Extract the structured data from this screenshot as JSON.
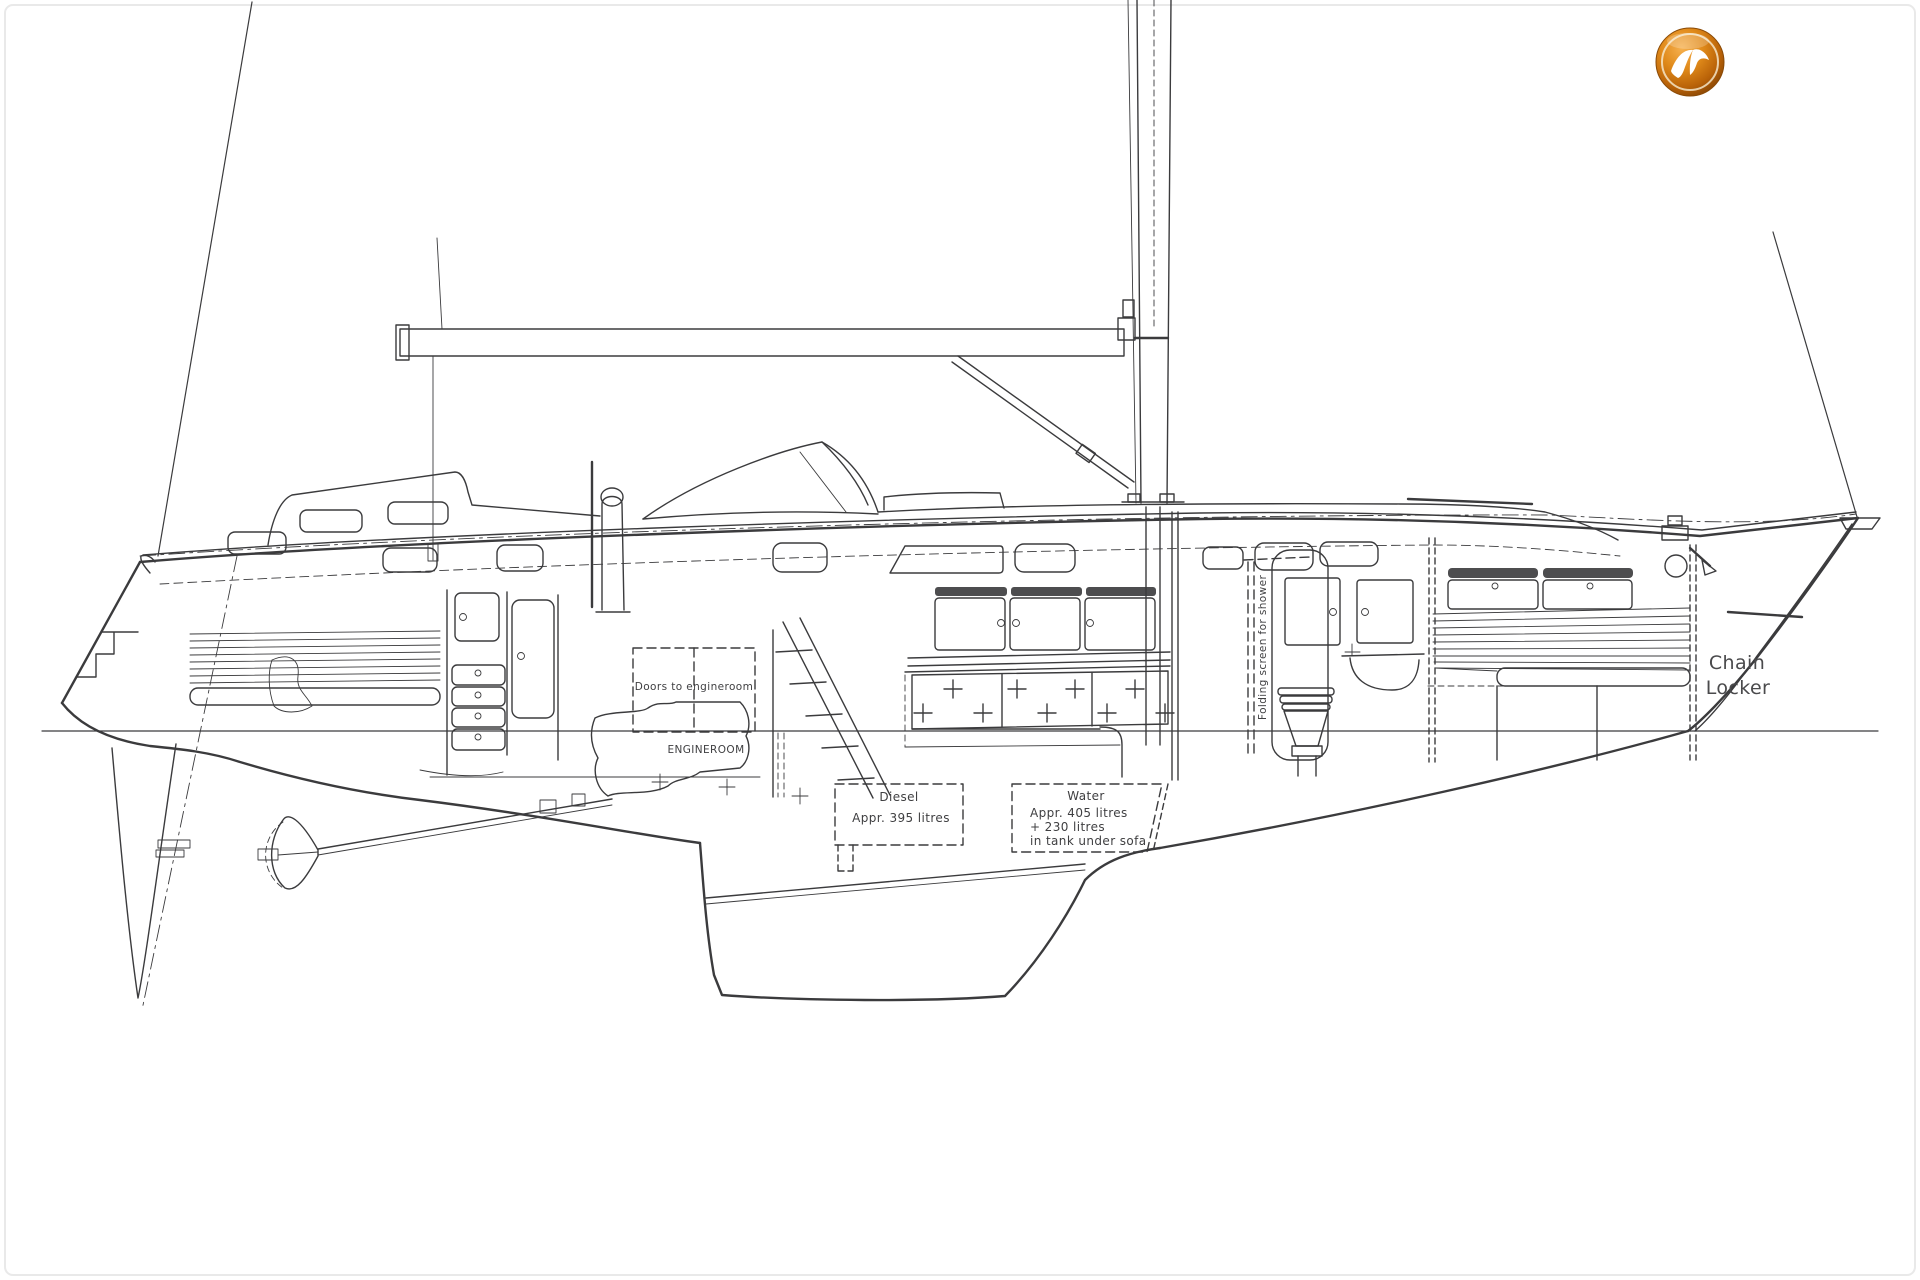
{
  "page": {
    "background": "#ffffff",
    "frame_color": "#e9e9e9",
    "ink_color": "#3b3b3d",
    "description": "Side-profile general arrangement drawing of a sailing yacht"
  },
  "logo": {
    "name": "yacht-brokerage-watermark",
    "ring_color": "#b96208",
    "light_color": "#f6b04e",
    "dark_color": "#7c3f04",
    "bird_color": "#ffffff"
  },
  "labels": {
    "chain_locker": {
      "line1": "Chain",
      "line2": "Locker"
    },
    "diesel_tank": {
      "title": "Diesel",
      "capacity": "Appr. 395 litres"
    },
    "water_tank": {
      "title": "Water",
      "capacity_line1": "Appr. 405 litres",
      "capacity_line2": "+ 230 litres",
      "capacity_line3": "in tank under sofa"
    },
    "engineroom": {
      "doors": "Doors to engineroom",
      "name": "ENGINEROOM"
    },
    "head": {
      "screen": "Folding screen for shower"
    }
  }
}
